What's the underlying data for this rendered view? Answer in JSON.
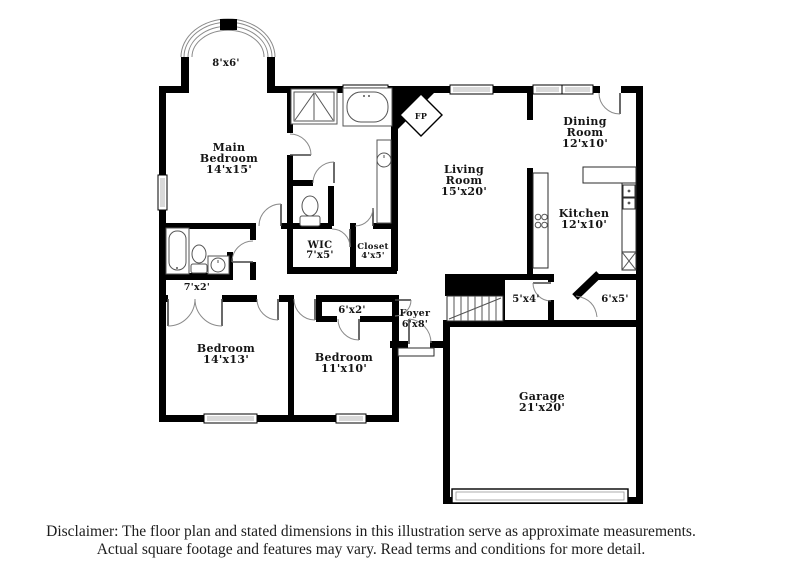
{
  "floor_plan": {
    "rooms": {
      "bay": {
        "lines": [
          "8'x6'"
        ]
      },
      "main_bedroom": {
        "lines": [
          "Main",
          "Bedroom",
          "14'x15'"
        ]
      },
      "living_room": {
        "lines": [
          "Living",
          "Room",
          "15'x20'"
        ]
      },
      "dining_room": {
        "lines": [
          "Dining",
          "Room",
          "12'x10'"
        ]
      },
      "kitchen": {
        "lines": [
          "Kitchen",
          "12'x10'"
        ]
      },
      "wic": {
        "lines": [
          "WIC",
          "7'x5'"
        ]
      },
      "closet": {
        "lines": [
          "Closet",
          "4'x5'"
        ]
      },
      "hall_7x2": {
        "lines": [
          "7'x2'"
        ]
      },
      "closet_6x2": {
        "lines": [
          "6'x2'"
        ]
      },
      "foyer": {
        "lines": [
          "Foyer",
          "6'x8'"
        ]
      },
      "room_5x4": {
        "lines": [
          "5'x4'"
        ]
      },
      "room_6x5": {
        "lines": [
          "6'x5'"
        ]
      },
      "bedroom_14x13": {
        "lines": [
          "Bedroom",
          "14'x13'"
        ]
      },
      "bedroom_11x10": {
        "lines": [
          "Bedroom",
          "11'x10'"
        ]
      },
      "garage": {
        "lines": [
          "Garage",
          "21'x20'"
        ]
      },
      "fireplace": {
        "lines": [
          "FP"
        ]
      }
    },
    "colors": {
      "wall": "#000000",
      "background": "#ffffff",
      "window_pane": "#d9d9d9"
    }
  },
  "disclaimer": {
    "line1": "Disclaimer: The floor plan and stated dimensions in this illustration serve as approximate measurements.",
    "line2": "Actual square footage and features may vary. Read terms and conditions for more detail."
  }
}
